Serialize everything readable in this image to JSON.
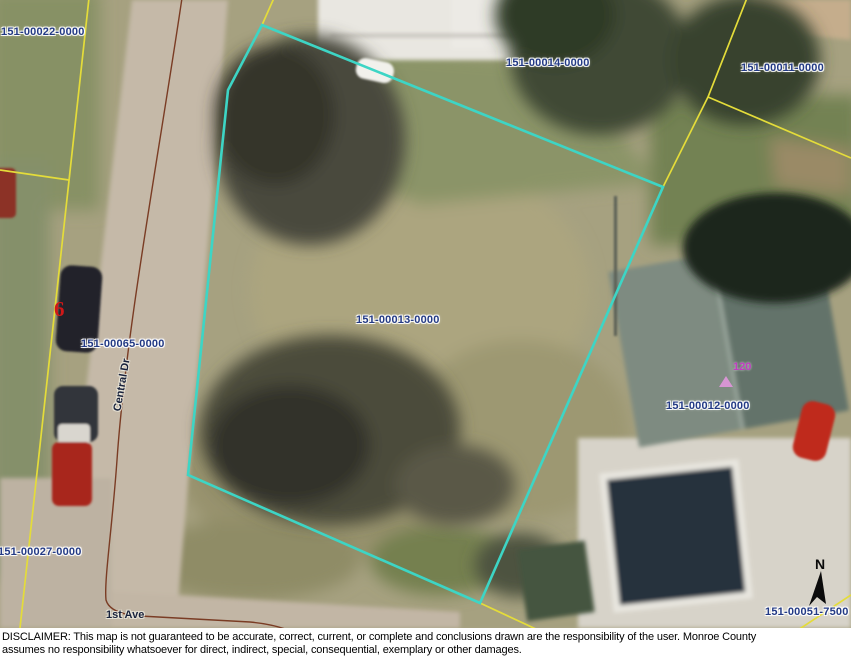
{
  "map": {
    "highlighted_parcel_id": "151-00013-0000",
    "parcel_labels": [
      {
        "id": "151-00022-0000"
      },
      {
        "id": "151-00014-0000"
      },
      {
        "id": "151-00011-0000"
      },
      {
        "id": "151-00013-0000"
      },
      {
        "id": "151-00065-0000"
      },
      {
        "id": "151-00012-0000"
      },
      {
        "id": "151-00027-0000"
      },
      {
        "id": "151-00051-7500"
      }
    ],
    "street_labels": {
      "central_dr": "Central Dr",
      "first_ave": "1st Ave"
    },
    "address_point": {
      "number": "120"
    },
    "lot_number": "6",
    "north_arrow_label": "N",
    "colors": {
      "parcel_boundary_yellow": "#e4dc3a",
      "highlighted_parcel_cyan": "#3dd5c5",
      "road_centerline_brown": "#7a3c24",
      "parcel_label_navy": "#233a85",
      "address_point_magenta": "#c03ec0",
      "lot_number_red": "#d01818"
    }
  },
  "disclaimer": {
    "line1": "DISCLAIMER: This map is not guaranteed to be accurate, correct, current, or complete and conclusions drawn are the responsibility of the user. Monroe County",
    "line2": "assumes no responsibility whatsoever for direct, indirect, special, consequential, exemplary or other damages."
  }
}
